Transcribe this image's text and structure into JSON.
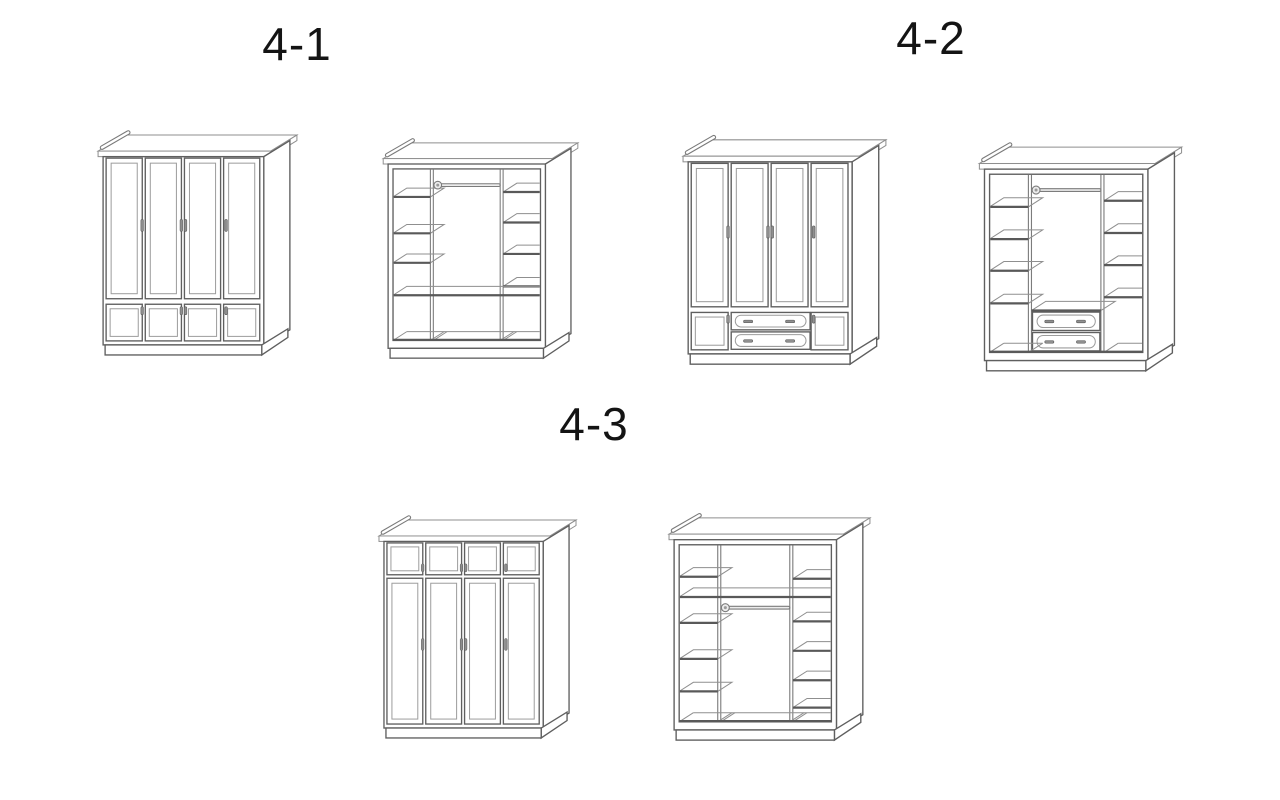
{
  "page": {
    "background_color": "#ffffff"
  },
  "colors": {
    "label_text": "#141414",
    "line_main": "#5f5f5f",
    "line_detail": "#8f8f8f",
    "shelf_edge": "#595959"
  },
  "groups": [
    {
      "label": "4-1",
      "figures": [
        "wardrobe-4-1-exterior-drawing",
        "wardrobe-4-1-interior-drawing"
      ]
    },
    {
      "label": "4-2",
      "figures": [
        "wardrobe-4-2-exterior-drawing",
        "wardrobe-4-2-interior-drawing"
      ]
    },
    {
      "label": "4-3",
      "figures": [
        "wardrobe-4-3-exterior-drawing",
        "wardrobe-4-3-interior-drawing"
      ]
    }
  ]
}
